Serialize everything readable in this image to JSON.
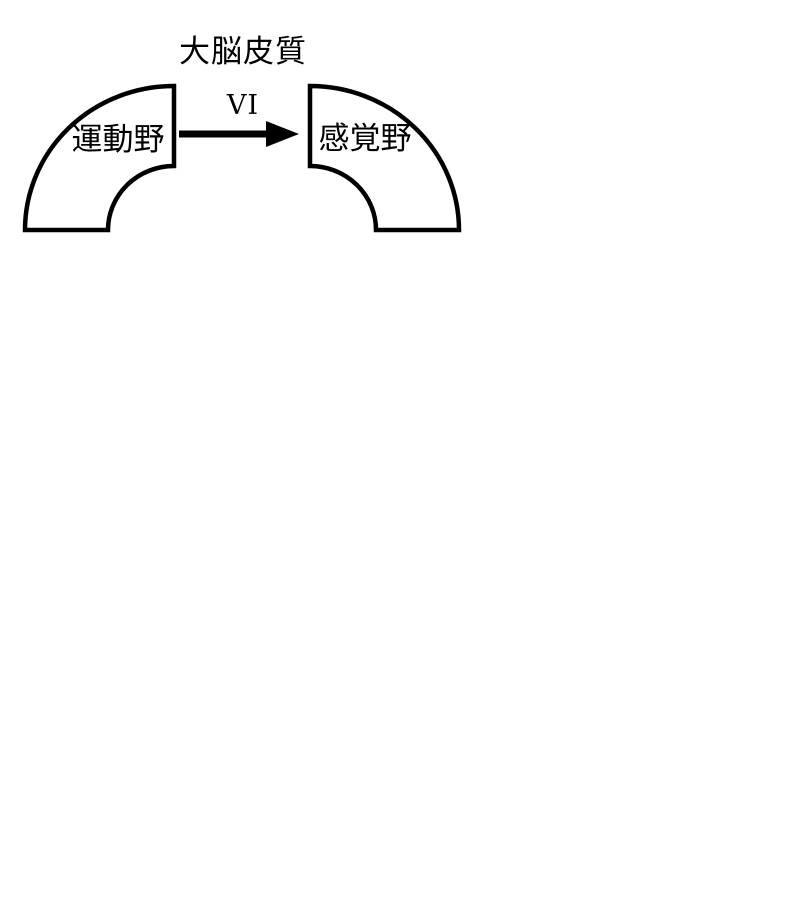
{
  "diagram": {
    "title": "大脳皮質",
    "nodes": [
      {
        "id": "motor",
        "label": "運動野"
      },
      {
        "id": "sensory",
        "label": "感覚野"
      }
    ],
    "arrow": {
      "label": "VI",
      "from": "motor",
      "to": "sensory",
      "direction": "left-to-right"
    },
    "colors": {
      "stroke": "#000000",
      "fill": "#ffffff",
      "background": "#ffffff"
    }
  }
}
